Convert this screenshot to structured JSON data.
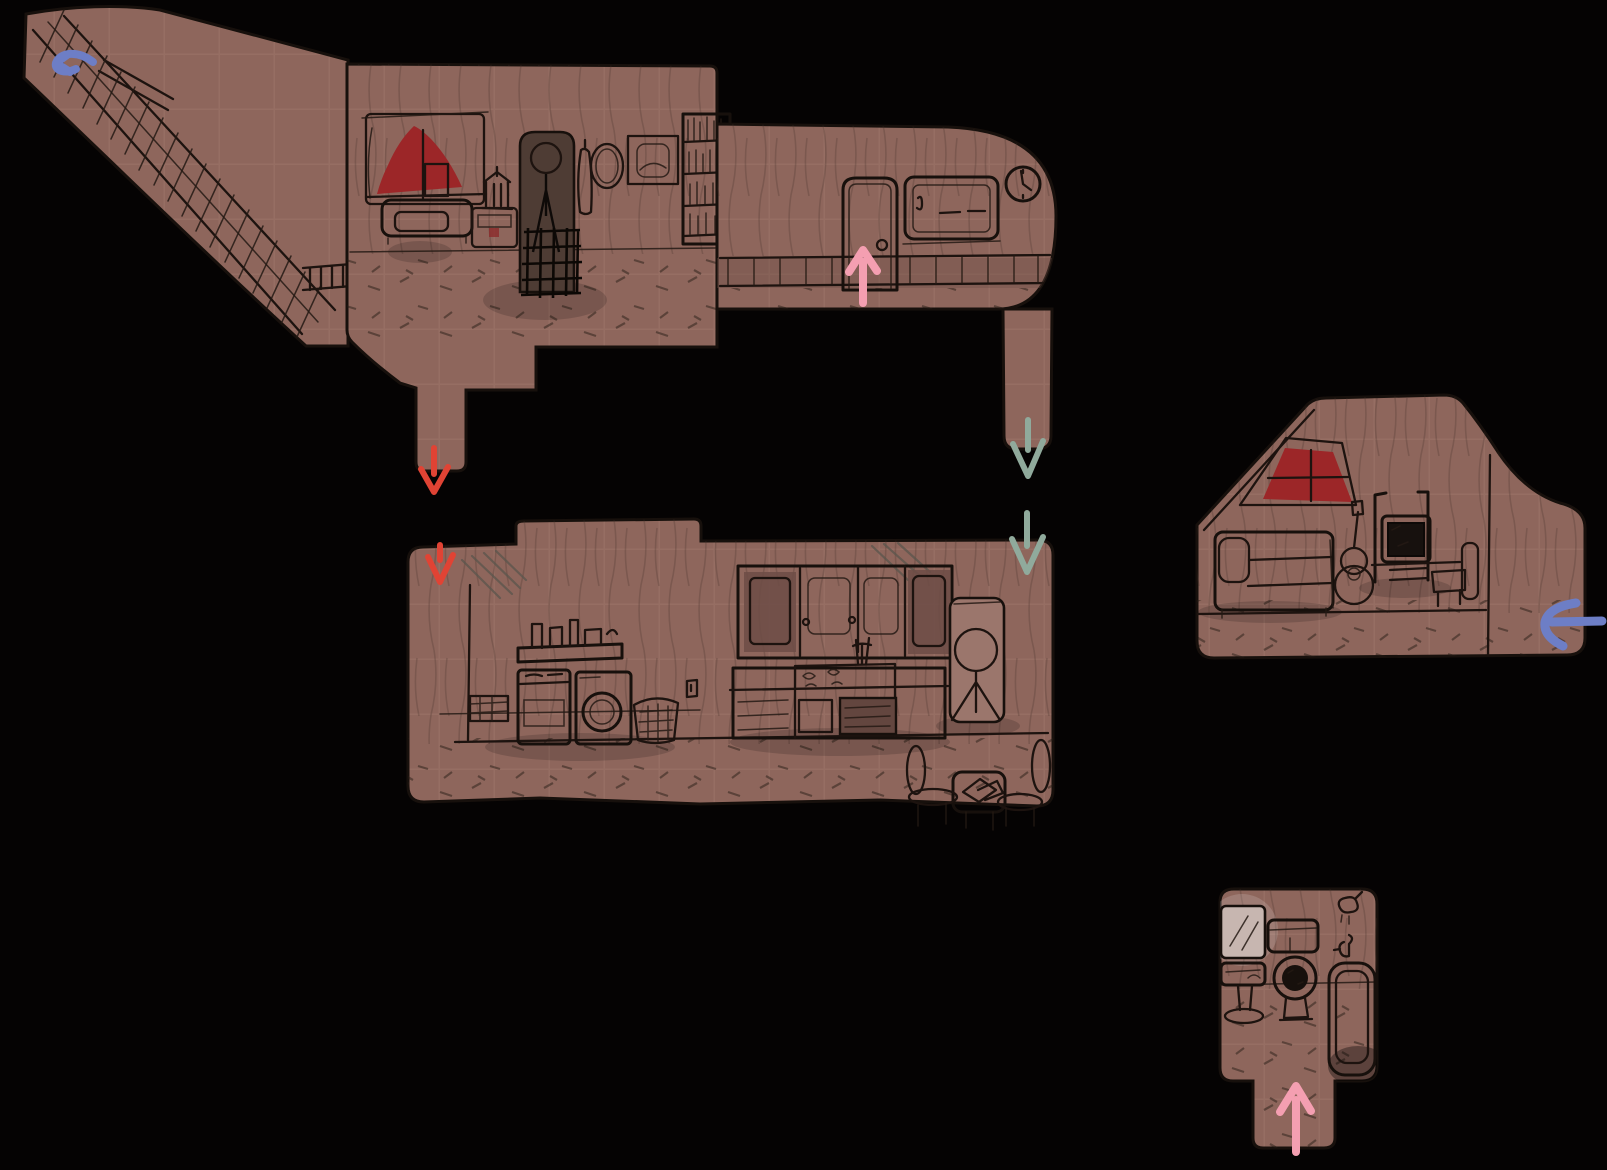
{
  "image": {
    "kind": "hand-drawn house map sketch",
    "width": 1607,
    "height": 1170,
    "background": "#050303",
    "description": "Side-view sketch map of a house: staircase and two upper rooms, a lower kitchen-laundry room, a separate attic bedroom, and a bathroom, connected by colored arrows"
  },
  "colors": {
    "background": "#050303",
    "room_fill": "#8e665c",
    "grid_line": "#9e756a",
    "sketch_line": "#1d130f",
    "wall_grain": "#3f2d26",
    "curtain_red": "#9c2628",
    "dark_inset": "#63463f",
    "closet_dark": "#4e3c34",
    "screen_dark": "#17110e",
    "mirror_light": "#c7b6b0",
    "board_light": "#9b766c",
    "arrow_red": "#e04334",
    "arrow_pink": "#f49fb1",
    "arrow_teal": "#90aa9c",
    "arrow_blue": "#6d7ec6"
  },
  "rooms": [
    {
      "id": "staircase",
      "label": "staircase with railing and landing"
    },
    {
      "id": "upper-bedroom",
      "label": "bedroom: curtained window, bed, lantern nightstand, dark closet with figure, hanging coat, oval mirror, picture frame, bookshelf"
    },
    {
      "id": "hallway",
      "label": "hallway: door, window, wall clock, wainscot railing"
    },
    {
      "id": "kitchen-laundry",
      "label": "kitchen and laundry: wall shelf with bottles, washer, dryer, basket, crate, upper cabinets, counter with stove and oven, stick-figure mirror board, dining table with chairs"
    },
    {
      "id": "attic-bedroom",
      "label": "attic bedroom: sloped roof, curtained window, bed, guitar, desk with monitor, chair, side passage"
    },
    {
      "id": "bathroom",
      "label": "bathroom: mirror, pedestal sink, toilet, shower head, tap, bathtub, entry corridor"
    }
  ],
  "arrows": [
    {
      "id": "stairs-exit",
      "color_key": "arrow_blue",
      "direction": "left",
      "location": "top of staircase"
    },
    {
      "id": "hallway-door",
      "color_key": "arrow_pink",
      "direction": "up",
      "location": "at hallway door"
    },
    {
      "id": "bedroom-drop-top",
      "color_key": "arrow_red",
      "direction": "down",
      "location": "notch below bedroom"
    },
    {
      "id": "bedroom-drop-bottom",
      "color_key": "arrow_red",
      "direction": "down",
      "location": "kitchen room top-left entry"
    },
    {
      "id": "hallway-drop-top",
      "color_key": "arrow_teal",
      "direction": "down",
      "location": "notch below hallway"
    },
    {
      "id": "hallway-drop-bottom",
      "color_key": "arrow_teal",
      "direction": "down",
      "location": "kitchen room top-right entry"
    },
    {
      "id": "attic-entry",
      "color_key": "arrow_blue",
      "direction": "left",
      "location": "right edge of attic bedroom"
    },
    {
      "id": "bathroom-entry",
      "color_key": "arrow_pink",
      "direction": "up",
      "location": "bathroom corridor"
    }
  ]
}
